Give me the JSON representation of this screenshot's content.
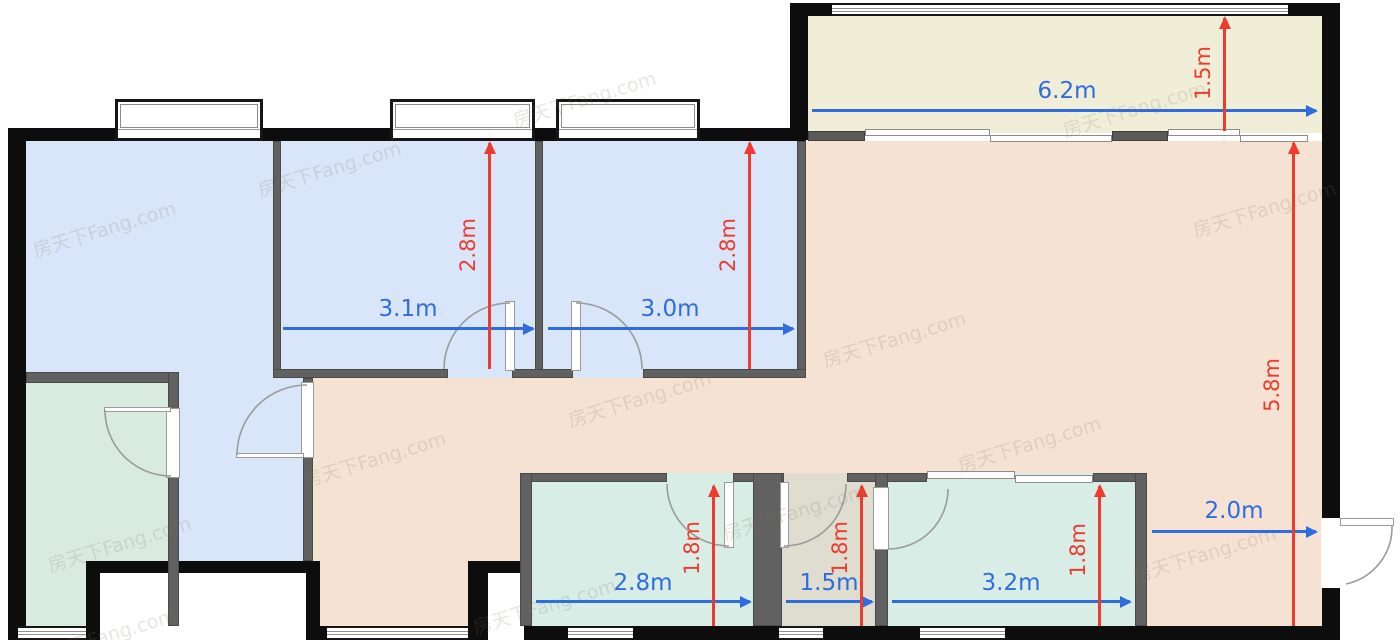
{
  "watermark": {
    "text": "房天下Fang.com"
  },
  "colors": {
    "exterior_wall": "#0d0d0d",
    "interior_wall": "#616161",
    "bedroom_blue": "#d9e5f8",
    "green_room": "#d9ebdf",
    "balcony_cream": "#f1eed8",
    "living_peach": "#f5e2d2",
    "teal_room": "#d8ede6",
    "utility_gray": "#deddd0",
    "dim_blue": "#2e6ce0",
    "dim_red": "#ef3b2d"
  },
  "dims": {
    "h": [
      {
        "label": "3.1m",
        "value_m": 3.1,
        "room": "bedroom-2-width"
      },
      {
        "label": "3.0m",
        "value_m": 3.0,
        "room": "bedroom-3-width"
      },
      {
        "label": "6.2m",
        "value_m": 6.2,
        "room": "balcony-width"
      },
      {
        "label": "2.8m",
        "value_m": 2.8,
        "room": "bottom-room-a-width"
      },
      {
        "label": "1.5m",
        "value_m": 1.5,
        "room": "bottom-room-b-width"
      },
      {
        "label": "3.2m",
        "value_m": 3.2,
        "room": "bottom-room-c-width"
      },
      {
        "label": "2.0m",
        "value_m": 2.0,
        "room": "entry-zone-width"
      }
    ],
    "v": [
      {
        "label": "2.8m",
        "value_m": 2.8,
        "room": "bedroom-2-depth"
      },
      {
        "label": "2.8m",
        "value_m": 2.8,
        "room": "bedroom-3-depth"
      },
      {
        "label": "1.5m",
        "value_m": 1.5,
        "room": "balcony-depth"
      },
      {
        "label": "5.8m",
        "value_m": 5.8,
        "room": "living-depth"
      },
      {
        "label": "1.8m",
        "value_m": 1.8,
        "room": "bottom-room-a-depth"
      },
      {
        "label": "1.8m",
        "value_m": 1.8,
        "room": "bottom-room-b-depth"
      },
      {
        "label": "1.8m",
        "value_m": 1.8,
        "room": "bottom-room-c-depth"
      }
    ]
  }
}
